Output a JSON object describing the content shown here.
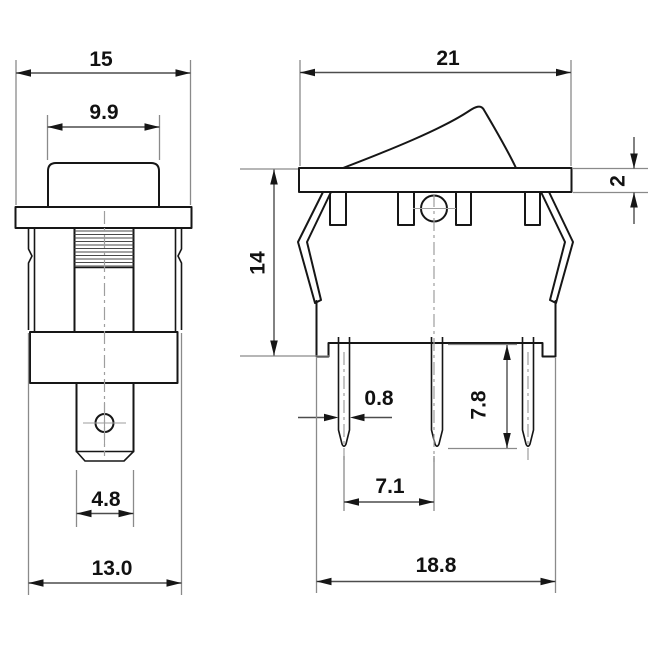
{
  "colors": {
    "background": "#ffffff",
    "object_line": "#161616",
    "dimension_line": "#4d4d4d",
    "extension_line": "#8a8a8a",
    "center_line": "#9e9e9e",
    "text": "#111111"
  },
  "front_view": {
    "overall_width": "15",
    "actuator_width": "9.9",
    "terminal_width": "4.8",
    "body_width": "13.0"
  },
  "side_view": {
    "overall_width": "21",
    "flange_thickness": "2",
    "body_depth": "14",
    "terminal_thickness": "0.8",
    "terminal_length": "7.8",
    "terminal_pitch": "7.1",
    "base_width": "18.8"
  }
}
